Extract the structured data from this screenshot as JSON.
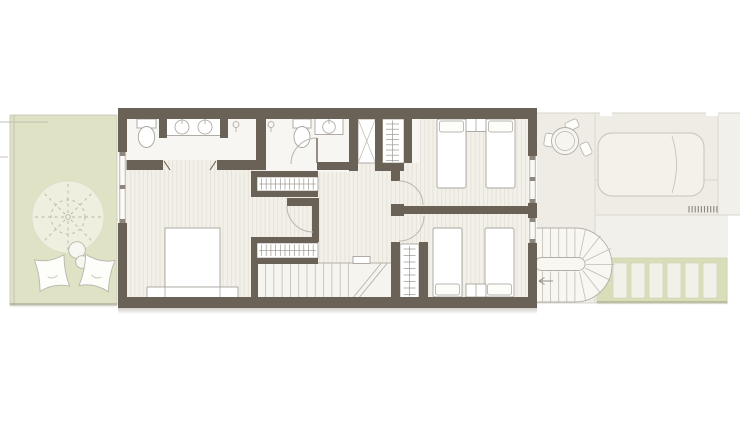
{
  "colors": {
    "background": "#ffffff",
    "wall": "#6a6157",
    "floor": "#f2f0e9",
    "floor_stripe": "#e6e3d9",
    "bath_floor": "#f7f6f2",
    "stair_floor": "#f5f4ef",
    "garden": "#dfe2c4",
    "garden_strip": "#d9deb8",
    "terrace": "#eeece5",
    "terrace_light": "#f2f0ea",
    "line": "#a8a59c",
    "line_light": "#b9b6ad",
    "pave_line": "#d9d6cb",
    "tree_line": "#b9b7a8",
    "furniture_fill": "#ffffff",
    "shadow": "#5a544a"
  },
  "symbols": [
    "tree",
    "bean-bag",
    "double-bed",
    "single-bed",
    "toilet",
    "sink",
    "double-vanity",
    "shower-head",
    "shower-stall",
    "wardrobe",
    "shelf-closet",
    "straight-staircase",
    "spiral-staircase",
    "round-table",
    "chair",
    "sun-lounger",
    "window",
    "door-swing",
    "garden-deck-slats",
    "drain-grille"
  ],
  "repeats": [
    {
      "target": "stair-treads",
      "type": "vline",
      "x0": 265.5,
      "step": 8.3,
      "count": 11,
      "y1": 263.5,
      "y2": 299.5
    },
    {
      "target": "wardrobe1-ticks",
      "type": "vline",
      "x0": 261.5,
      "step": 4.7,
      "count": 12,
      "y1": 178.5,
      "y2": 189.5
    },
    {
      "target": "wardrobe2-ticks",
      "type": "vline",
      "x0": 261.5,
      "step": 4.7,
      "count": 12,
      "y1": 244.5,
      "y2": 256
    },
    {
      "target": "closetA-ticks",
      "type": "hline",
      "y0": 124,
      "step": 5.2,
      "count": 8,
      "x1": 386,
      "x2": 399
    },
    {
      "target": "closetB-ticks",
      "type": "hline",
      "y0": 249,
      "step": 6.5,
      "count": 8,
      "x1": 403.5,
      "x2": 415.5
    },
    {
      "target": "deck-slats",
      "type": "rect",
      "x0": 613,
      "step": 18,
      "count": 6,
      "y": 263,
      "w": 14,
      "h": 35,
      "rx": 1
    },
    {
      "target": "spiral-treads-top",
      "type": "vline",
      "x0": 542.5,
      "step": 8.1,
      "count": 5,
      "y1": 228.5,
      "y2": 257.5
    },
    {
      "target": "spiral-treads-bottom",
      "type": "vline",
      "x0": 542.5,
      "step": 8.1,
      "count": 5,
      "y1": 271.5,
      "y2": 301.5
    },
    {
      "target": "spiral-radials",
      "type": "radial",
      "cx": 578,
      "cy": 264.5,
      "r1": 8,
      "r2": 36.5,
      "a0": -78,
      "astep": 26,
      "count": 7
    },
    {
      "target": "tree-spokes",
      "type": "radial",
      "cx": 68,
      "cy": 217,
      "r1": 4,
      "r2": 35.5,
      "a0": 0,
      "astep": 45,
      "count": 8
    },
    {
      "target": "drain-grille",
      "type": "vline",
      "x0": 689,
      "step": 3.1,
      "count": 10,
      "y1": 206,
      "y2": 212.5
    }
  ]
}
